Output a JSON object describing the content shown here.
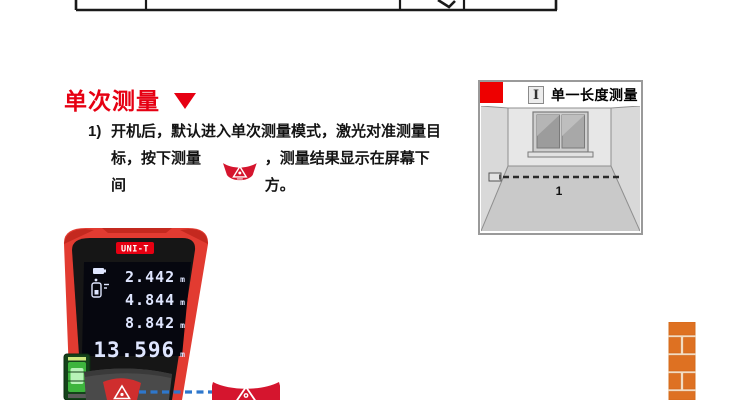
{
  "colors": {
    "accent_red": "#e60012",
    "device_red": "#e23b31",
    "button_red": "#d5152e",
    "laser_blue": "#2e77cc",
    "brick_orange": "#de7122",
    "screen_digit": "#dfe6ff"
  },
  "section": {
    "title": "单次测量",
    "step_no": "1)",
    "line1": "开机后，默认进入单次测量模式，激光对准测量目",
    "line2_pre": "标，按下测量间",
    "line2_post": "，测量结果显示在屏幕下方。"
  },
  "diagram": {
    "icon_label": "I",
    "title": "单一长度测量",
    "distance_label": "1"
  },
  "device": {
    "brand": "UNI-T",
    "readings": [
      {
        "value": "2.442",
        "unit": "m"
      },
      {
        "value": "4.844",
        "unit": "m"
      },
      {
        "value": "8.842",
        "unit": "m"
      },
      {
        "value": "13.596",
        "unit": "m"
      }
    ]
  }
}
